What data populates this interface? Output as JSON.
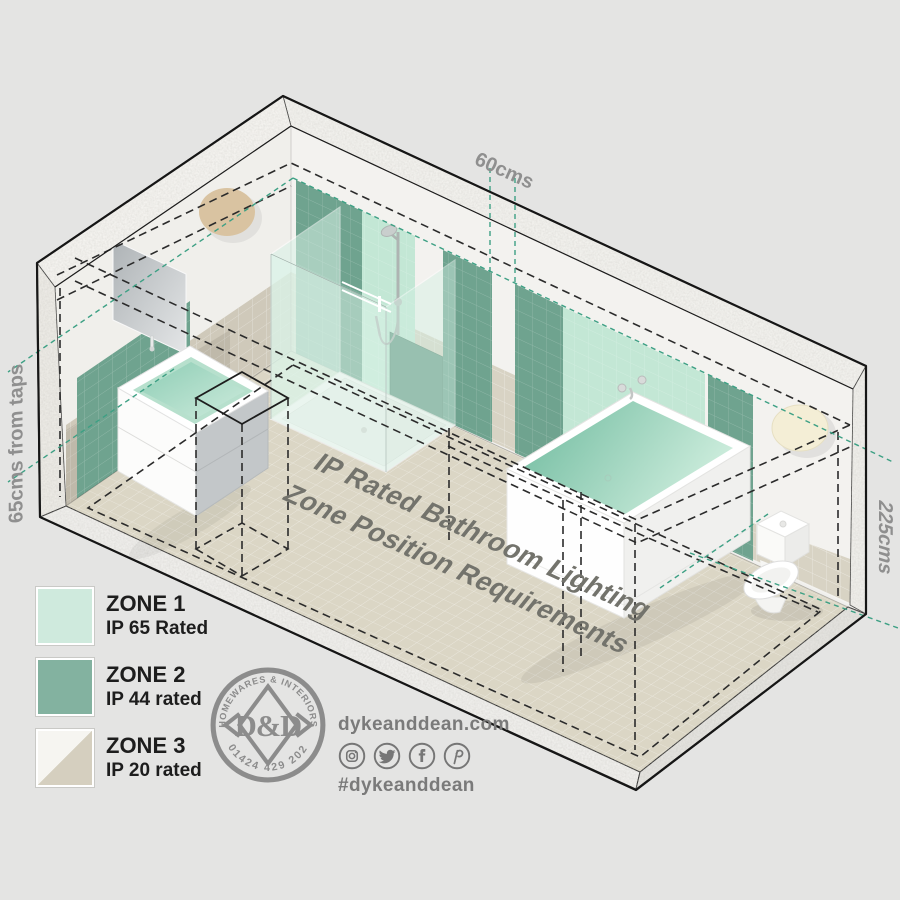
{
  "diagram": {
    "floor_title_line1": "IP Rated Bathroom Lighting",
    "floor_title_line2": "Zone Position Requirements",
    "dim_top": "60cms",
    "dim_left": "65cms from taps",
    "dim_right": "225cms"
  },
  "legend": {
    "items": [
      {
        "zone": "ZONE 1",
        "rating": "IP 65 Rated",
        "color": "#cfeadd"
      },
      {
        "zone": "ZONE 2",
        "rating": "IP 44 rated",
        "color": "#83b2a0"
      },
      {
        "zone": "ZONE 3",
        "rating": "IP 20 rated",
        "color_top": "#f6f5f1",
        "color_bottom": "#d5cfbf"
      }
    ]
  },
  "stamp": {
    "arc_top": "HOMEWARES & INTERIORS",
    "arc_bottom": "01424 429 202",
    "monogram": "D&D"
  },
  "social": {
    "website": "dykeanddean.com",
    "hashtag": "#dykeanddean",
    "icons": [
      "instagram-icon",
      "twitter-icon",
      "facebook-icon",
      "pinterest-icon"
    ]
  },
  "colors": {
    "background": "#e4e4e3",
    "zone1_mint": "#c3e7d5",
    "zone2_green": "#6fa38f",
    "zone3_beige": "#d5cfbf",
    "floor": "#dbd6c5",
    "dashed_teal": "#3da084",
    "dashed_black": "#2b2b2b",
    "label_gray": "#8f8f8f"
  }
}
